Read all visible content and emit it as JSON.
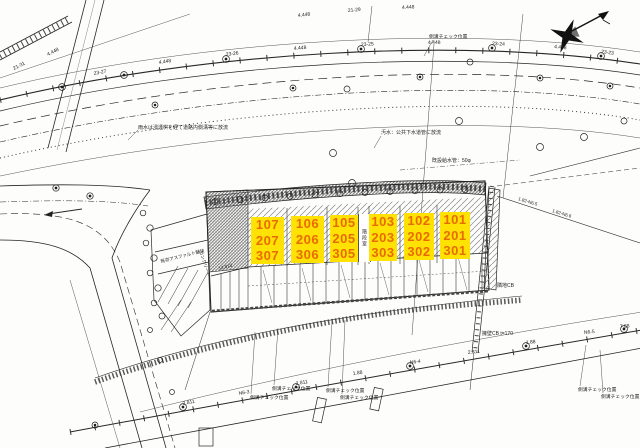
{
  "drawing": {
    "background": "#fdfdfc",
    "line_color": "#1f1f1f"
  },
  "icons": {
    "north_arrow": "north-arrow"
  },
  "units": {
    "highlight": "#ffe103",
    "digit_color": "#e96b00",
    "stair_label": "階段室",
    "columns": [
      {
        "rows": [
          "107",
          "207",
          "307"
        ]
      },
      {
        "rows": [
          "106",
          "206",
          "306"
        ]
      },
      {
        "rows": [
          "105",
          "205",
          "305"
        ]
      },
      {
        "rows": [
          "103",
          "203",
          "303"
        ]
      },
      {
        "rows": [
          "102",
          "202",
          "302"
        ]
      },
      {
        "rows": [
          "101",
          "201",
          "301"
        ]
      }
    ]
  },
  "annotations": {
    "rain_note": "雨水は浸透桝を経て道路内側溝等に放流",
    "sewage_note": "汚水：公共下水道管に放流",
    "water_pipe": "既設給水管：50φ",
    "gutter_check": "側溝チェック位置",
    "retaining_wall": "擁壁CB t=170",
    "neighbor_cb": "隣地CB",
    "asphalt": "既存アスファルト舗装",
    "concrete": "コンクリート",
    "dim_annex": "14,813"
  },
  "ticks": {
    "top": [
      "23-27",
      "4.448",
      "23-26",
      "4.448",
      "23-25",
      "4.448",
      "23-24",
      "4.448",
      "23-23"
    ],
    "upper": [
      "4.448",
      "21-29",
      "4.448",
      "21-31",
      "4.448"
    ],
    "bottom": [
      "2.811",
      "N6-3",
      "2.811",
      "1.88",
      "N6-4",
      "2.811",
      "1.88",
      "N6-5",
      "7.88"
    ],
    "right": [
      "1.82-N6.5",
      "1.82-N6.6"
    ]
  }
}
